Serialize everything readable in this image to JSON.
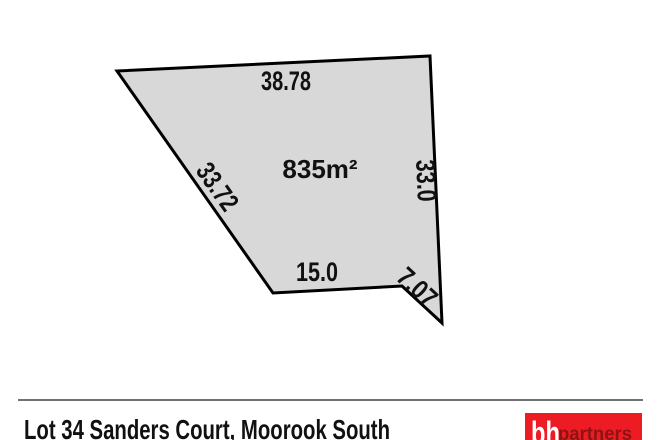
{
  "plan": {
    "area_label": "835m²",
    "dimensions": {
      "top": "38.78",
      "left": "33.72",
      "right": "33.0",
      "bottom": "15.0",
      "corner": "7.07"
    }
  },
  "footer": {
    "address": "Lot 34 Sanders Court, Moorook South"
  },
  "logo": {
    "monogram": "bh",
    "wordmark": "partners"
  },
  "colors": {
    "lot_fill": "#d8d8d8",
    "lot_stroke": "#000000",
    "divider": "#444444",
    "logo_background": "#ed1c24",
    "logo_text": "#8e1313",
    "text": "#111111"
  }
}
